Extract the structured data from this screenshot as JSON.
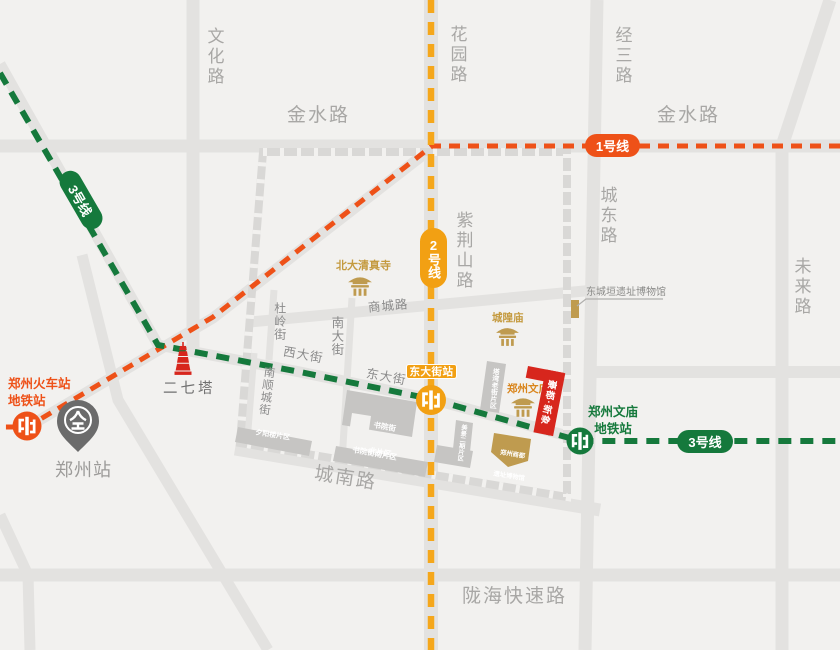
{
  "roads": {
    "wenhua": "文化路",
    "huayuan": "花园路",
    "jingsan": "经三路",
    "jinshui_left": "金水路",
    "jinshui_right": "金水路",
    "chengdong": "城东路",
    "weilai": "未来路",
    "zijinshan": "紫荆山路",
    "shangcheng": "商城路",
    "chengnan": "城南路",
    "longhai": "陇海快速路",
    "xidajie": "西大街",
    "dongdajie": "东大街",
    "nandajie": "南大街",
    "duling": "杜岭街",
    "nanshuncheng": "南顺城街"
  },
  "metro": {
    "line1": {
      "label": "1号线",
      "color": "#ee5118"
    },
    "line2": {
      "label": "2号线",
      "color": "#f2a013"
    },
    "line3": {
      "label": "3号线",
      "color": "#15793c"
    },
    "stations": {
      "railway": {
        "line1": "郑州火车站",
        "line2": "地铁站"
      },
      "dongdajie": {
        "label": "东大街站"
      },
      "wenmiao": {
        "line1": "郑州文庙",
        "line2": "地铁站"
      }
    }
  },
  "landmarks": {
    "mosque": "北大清真寺",
    "chenghuangmiao": "城隍庙",
    "dongchengyuan_museum": "东城垣遗址博物馆",
    "wenmiao": "郑州文庙",
    "erqi_tower": "二七塔",
    "zhengzhou_station": "郑州站",
    "shangdu_museum": {
      "line1": "郑州商都",
      "line2": "遗址博物馆"
    }
  },
  "districts": {
    "shuyuan_north": {
      "line1": "书院街",
      "line2": "北片区"
    },
    "shuyuan_south": "书院街南片区",
    "xiyanglou": "夕阳楼片区",
    "tawan": "塔湾老街片区",
    "meijing": "美景二期片区"
  },
  "project": {
    "name": "豪都·新象",
    "color": "#d7261d"
  }
}
